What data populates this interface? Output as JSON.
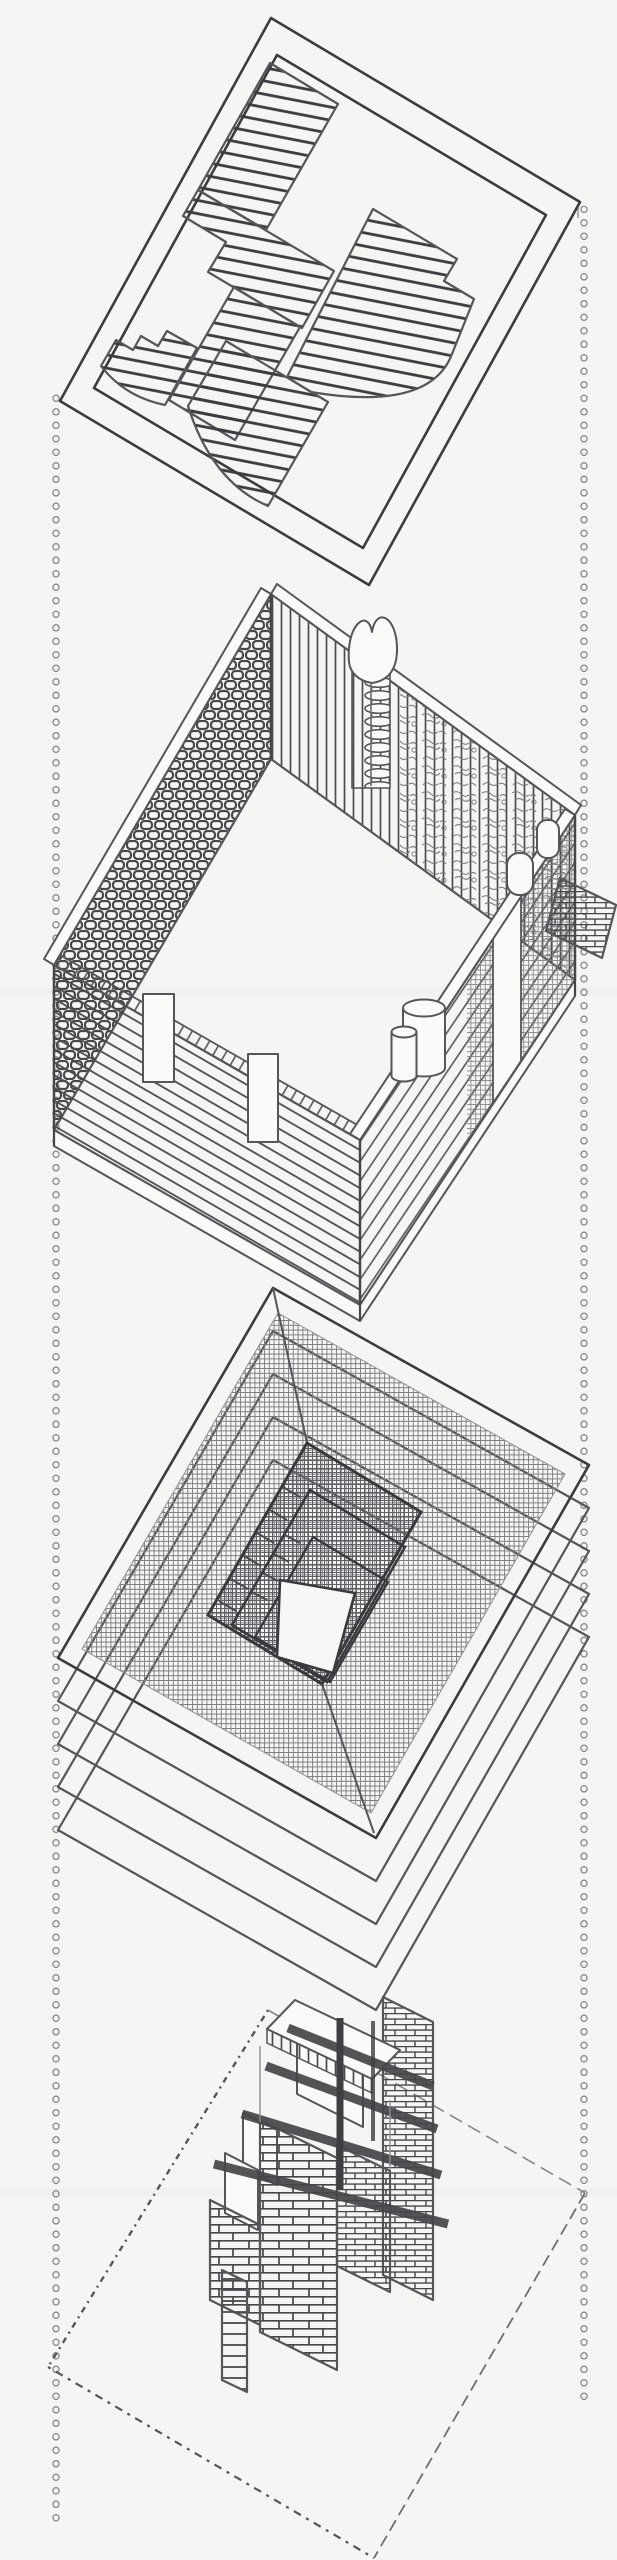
{
  "palette": {
    "paper": "#f6f5f3",
    "ink-strong": "#3c3c40",
    "ink": "#55555a",
    "ink-soft": "#77777c",
    "ink-faint": "#8e8e92",
    "fill-white": "#fbfaf8",
    "plate": "#faf9f7"
  },
  "scene": {
    "kind": "hand-drawn exploded axonometric architectural study",
    "projection": "plan-oblique 30/60 axonometric, pencil-sketch linework",
    "layers": [
      {
        "name": "roof-plate",
        "appearance": "flat framed plate with pinwheel plan of diagonal plank hatching, curved lobes and small stepped pier"
      },
      {
        "name": "perimeter-walls",
        "appearance": "rectangular ring of walls: cobble-stone wall, vertical stud walls, plank siding, heart-topped chimney with stacked log ends, white pilasters, pills and cylinders at corners"
      },
      {
        "name": "floor-slab-stack",
        "appearance": "four stacked slabs under a woven-mesh top plate with nested stepped stair core and white floor opening"
      },
      {
        "name": "ground-plane",
        "appearance": "dashed square outline drawn with irregular tick marks"
      },
      {
        "name": "brick-core",
        "appearance": "cruciform brick fireplace core with stacked piers, four dark crossing beams, vertical flue poles and plank fin"
      }
    ],
    "tie_lines": {
      "left": "vertical column of small hollow circles",
      "right": "vertical column of small hollow circles"
    }
  }
}
